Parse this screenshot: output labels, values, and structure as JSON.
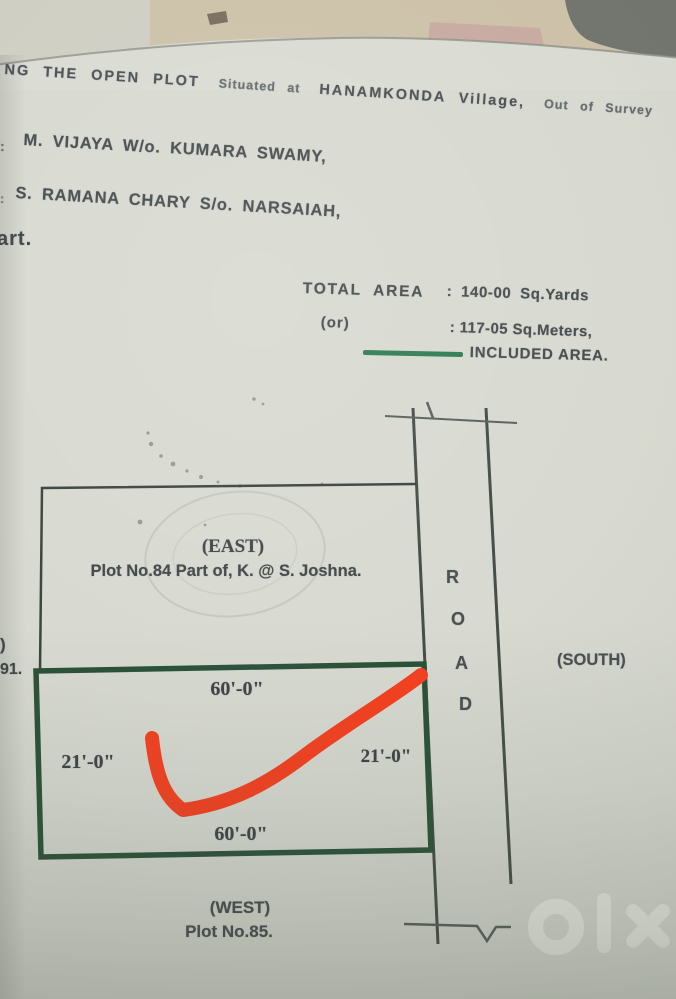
{
  "photo": {
    "paper_color": "#d8dad1",
    "table_surface_color": "#cdc2a9",
    "dark_corner_color": "#72766f"
  },
  "header": {
    "line1_part1": "NG  THE  OPEN  PLOT",
    "line1_part2": "Situated  at",
    "line1_part3": "HANAMKONDA  Village,",
    "line1_part4": "Out  of  Survey",
    "owner1_prefix": ":",
    "owner1": "M. VIJAYA  W/o. KUMARA SWAMY,",
    "owner2_prefix": ":",
    "owner2": "S. RAMANA CHARY  S/o. NARSAIAH,",
    "cutoff_word": "art."
  },
  "area_summary": {
    "total_label": "TOTAL  AREA",
    "total_value": ": 140-00  Sq.Yards",
    "or_label": "(or)",
    "meters_value": ":  117-05 Sq.Meters,",
    "included_label": "INCLUDED AREA.",
    "included_line_color": "#2f7c52"
  },
  "plot_diagram": {
    "east_label": "(EAST)",
    "adjacent_plot_east": "Plot No.84 Part of, K. @ S.  Joshna.",
    "dim_top": "60'-0\"",
    "dim_left": "21'-0\"",
    "dim_right": "21'-0\"",
    "dim_bottom": "60'-0\"",
    "road_letters": [
      "R",
      "O",
      "A",
      "D"
    ],
    "south_label": "(SOUTH)",
    "west_label": "(WEST)",
    "adjacent_plot_west": "Plot No.85.",
    "left_edge_cutoff_1": ")",
    "left_edge_cutoff_2": "91.",
    "plot_border_color": "#2a5138",
    "check_mark_color": "#f5401f"
  },
  "watermark": {
    "brand": "olx"
  }
}
